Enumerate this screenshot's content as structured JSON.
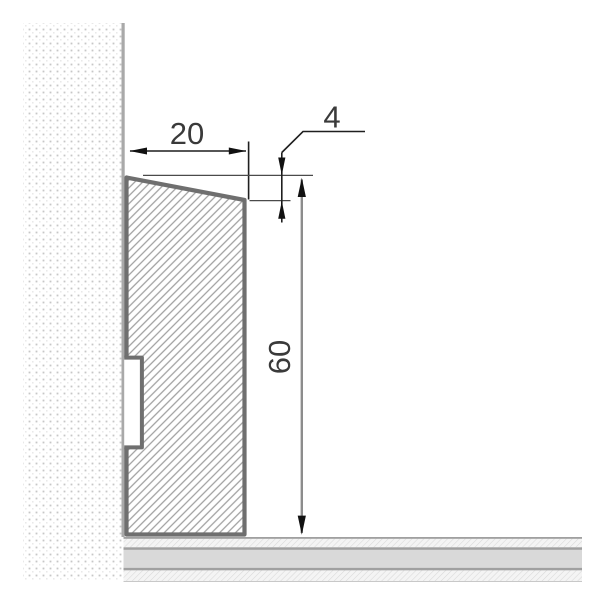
{
  "drawing": {
    "type": "technical-cross-section",
    "subject": "skirting-board-profile-on-wall-with-floor"
  },
  "dimensions": {
    "width_label": "20",
    "bevel_label": "4",
    "height_label": "60"
  },
  "colors": {
    "background": "#ffffff",
    "wall_dot": "#c7c7c7",
    "wall_dot_faint": "#e4e4e4",
    "wall_edge": "#a9a9a9",
    "profile_border": "#6f6f6f",
    "profile_hatch": "#9f9f9f",
    "floor_line": "#a0a0a0",
    "floor_faint_line": "#c8c8c8",
    "floor_solid": "#d9d9d9",
    "floor_hatch": "#d8d8d8",
    "floor_hatch_bg": "#f4f4f4",
    "dim_line": "#1f1f1f",
    "level_line": "#4a4a4a",
    "height_dim_line": "#8c8c8c",
    "arrow": "#111111",
    "dim_text": "#3a3a3a"
  }
}
